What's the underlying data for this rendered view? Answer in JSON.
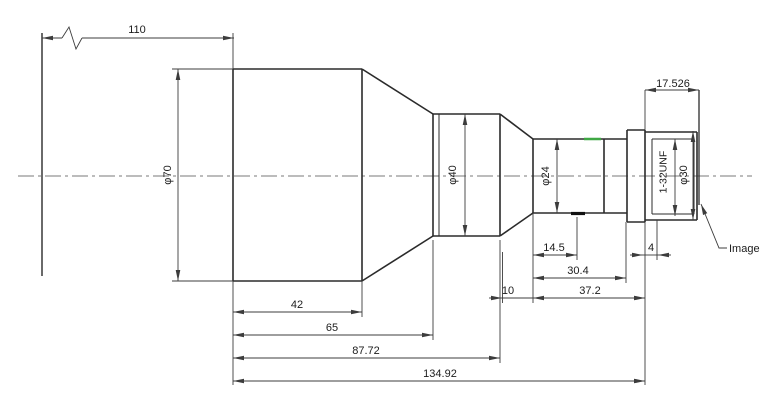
{
  "drawing": {
    "type": "lens-mechanical-outline-drawing",
    "dimensions": {
      "d110": "110",
      "d17_526": "17.526",
      "phi70": "φ70",
      "phi40": "φ40",
      "phi24": "φ24",
      "thread": "1-32UNF",
      "phi30": "φ30",
      "d14_5": "14.5",
      "d30_4": "30.4",
      "d10": "10",
      "d37_2": "37.2",
      "d4": "4",
      "d42": "42",
      "d65": "65",
      "d87_72": "87.72",
      "d134_92": "134.92"
    },
    "labels": {
      "image_plane": "Image"
    },
    "colors": {
      "object_line": "#2b2b2b",
      "dimension_line": "#3c3c3c",
      "centerline": "#7a7a7a",
      "highlight_green": "#3fa844",
      "background": "#ffffff"
    }
  }
}
